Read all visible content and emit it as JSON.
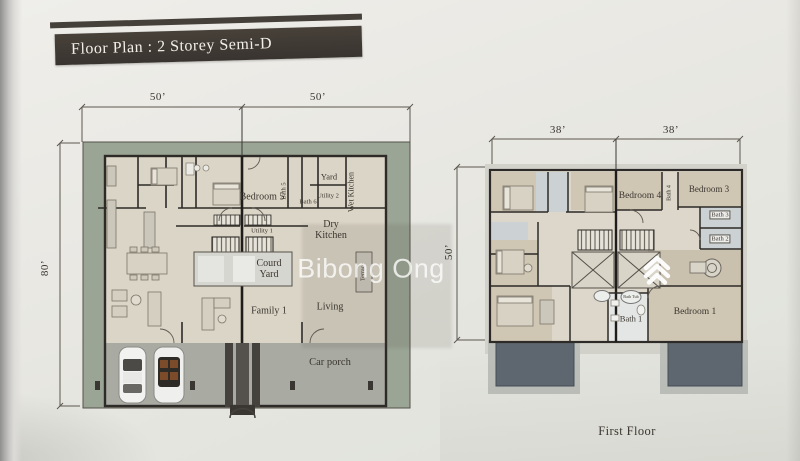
{
  "page": {
    "title": "Floor Plan :  2 Storey Semi-D"
  },
  "watermark": {
    "text": "Bibong Ong",
    "logo_icon": "stacked-chevron-logo"
  },
  "ground_floor": {
    "dims": {
      "top_left": "50’",
      "top_right": "50’",
      "left": "80’"
    },
    "labels": {
      "bedroom5": "Bedroom 5",
      "bath5": "Bath 5",
      "bath6": "Bath 6",
      "yard": "Yard",
      "utility2": "Utility 2",
      "wet_kitchen": "Wet Kitchen",
      "utility1": "Utility 1",
      "dry_kitchen": "Dry Kitchen",
      "courtyard": "Courd Yard",
      "terrace": "Terrace",
      "family1": "Family 1",
      "living": "Living",
      "car_porch": "Car porch"
    }
  },
  "first_floor": {
    "dims": {
      "top_left": "38’",
      "top_right": "38’",
      "left": "50’"
    },
    "labels": {
      "bedroom4": "Bedroom 4",
      "bath4": "Bath 4",
      "bedroom3": "Bedroom 3",
      "bath3": "Bath 3",
      "bath2": "Bath 2",
      "bedroom1": "Bedroom 1",
      "bath1": "Bath 1",
      "bath_tub": "Bath Tub"
    },
    "caption": "First Floor"
  },
  "colors": {
    "title_bar": "#3d3833",
    "grass_border": "#9aa595",
    "floor_beige": "#dbd5c7",
    "car_porch_gray": "#a9aba3",
    "room_tan": "#cfc6b4",
    "bath_blue": "#ccd2d3",
    "balcony_gray": "#5e6770",
    "wall": "#2d2a27"
  }
}
